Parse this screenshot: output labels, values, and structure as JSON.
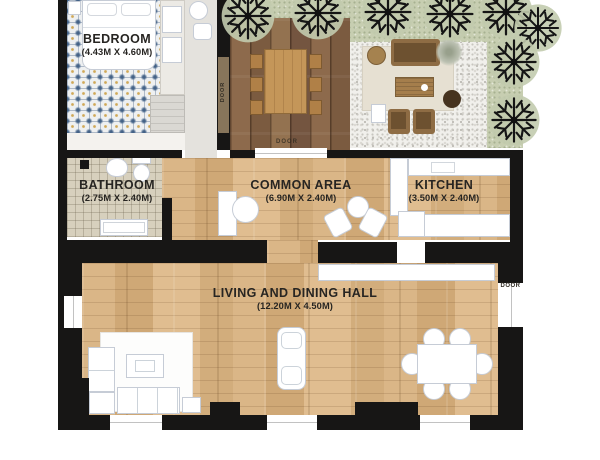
{
  "rooms": {
    "bedroom": {
      "name": "BEDROOM",
      "dims": "(4.43M X 4.60M)"
    },
    "bathroom": {
      "name": "BATHROOM",
      "dims": "(2.75M X 2.40M)"
    },
    "common_area": {
      "name": "COMMON AREA",
      "dims": "(6.90M X 2.40M)"
    },
    "kitchen": {
      "name": "KITCHEN",
      "dims": "(3.50M X 2.40M)"
    },
    "living_dining": {
      "name": "LIVING AND DINING HALL",
      "dims": "(12.20M X 4.50M)"
    }
  },
  "doors": {
    "bedroom_deck_label": "DOOR",
    "deck_entry_label": "DOOR",
    "living_right_label": "DOOR"
  },
  "colors": {
    "wall": "#171615",
    "wood_light": "#d7b384",
    "wood_deck": "#876548",
    "bath_tile": "#d7d0bd",
    "lawn": "#c7ceb1",
    "gravel": "#f1f0ec",
    "furniture_outline": "#c6ccd6",
    "accent_text": "#272522"
  }
}
